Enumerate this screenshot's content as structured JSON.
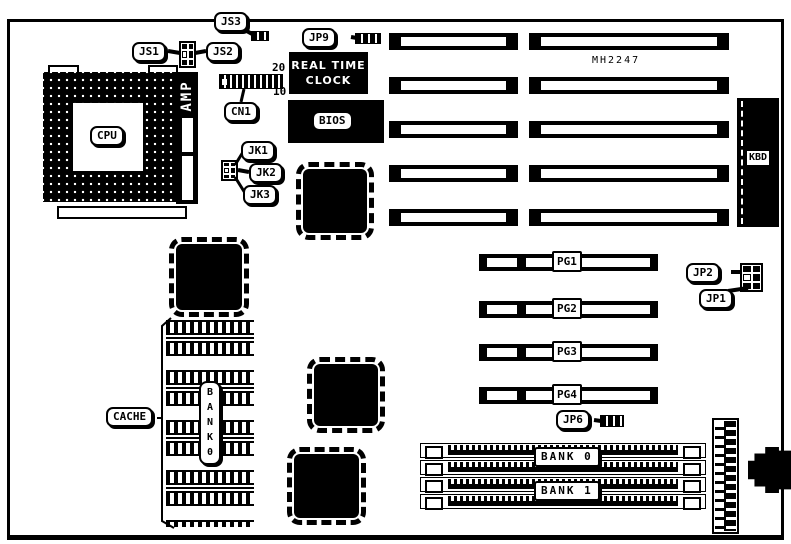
{
  "colors": {
    "ink": "#000000",
    "paper": "#ffffff"
  },
  "board": {
    "cpu_label": "CPU",
    "amp_label": "AMP",
    "rtc_line1": "REAL TIME",
    "rtc_line2": "CLOCK",
    "bios_label": "BIOS",
    "chip_part_number": "MH2247",
    "kbd_label": "KBD",
    "cache_label": "CACHE",
    "cache_bank_vertical": "B\nA\nN\nK\n0",
    "cn1": {
      "label": "CN1",
      "pin_top": "20",
      "pin_bottom": "10"
    },
    "jumpers": {
      "js1": "JS1",
      "js2": "JS2",
      "js3": "JS3",
      "jp9": "JP9",
      "jk1": "JK1",
      "jk2": "JK2",
      "jk3": "JK3",
      "jp2": "JP2",
      "jp1": "JP1",
      "jp6": "JP6"
    },
    "pg_slots": [
      "PG1",
      "PG2",
      "PG3",
      "PG4"
    ],
    "memory_banks": [
      "BANK 0",
      "BANK 1"
    ]
  }
}
